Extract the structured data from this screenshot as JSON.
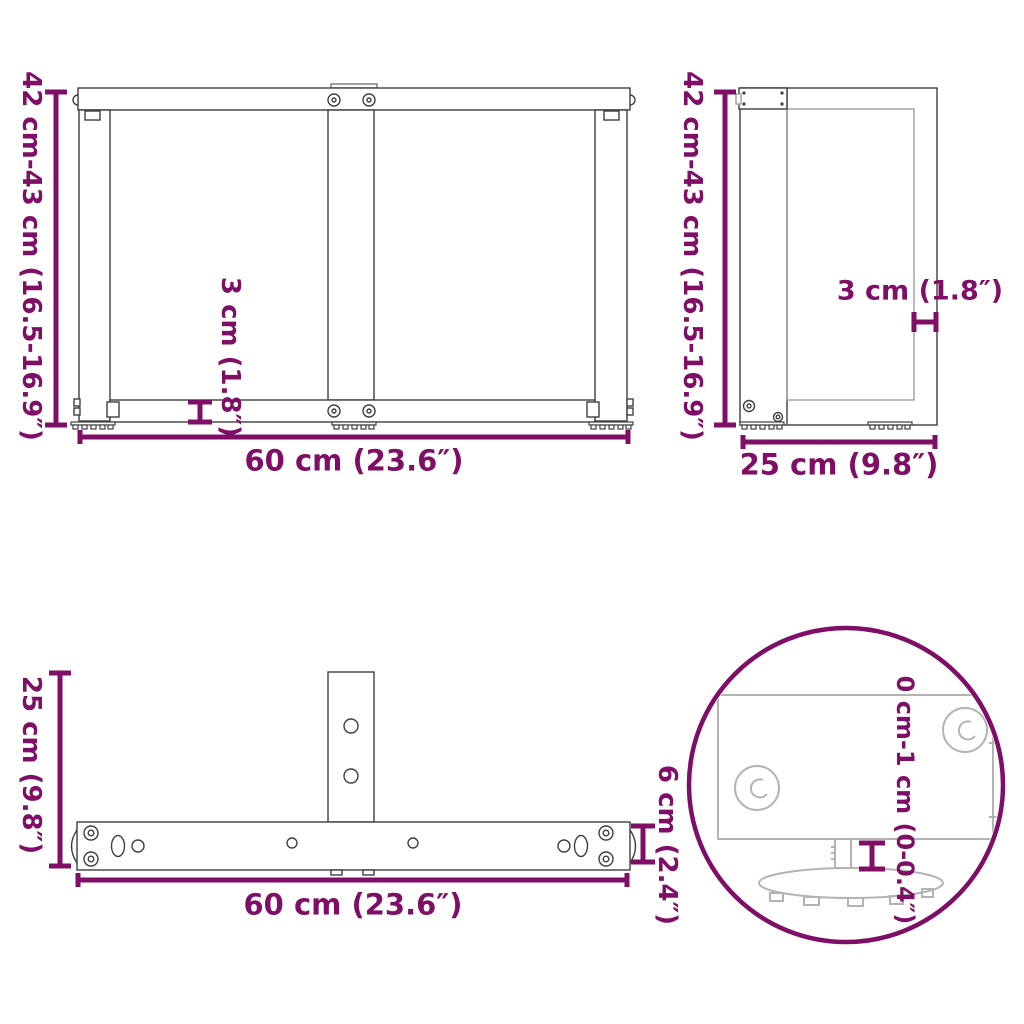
{
  "document": {
    "type": "product-dimension-diagram",
    "subject": "T-shaped table leg frame",
    "background_color": "#FFFFFF",
    "accent_color": "#7F0E66",
    "drawing_color_dark": "#3F3F3F",
    "drawing_color_light": "#9E9E9E",
    "detail_drawing_color": "#B3B3B3"
  },
  "views": {
    "front": {
      "name": "front-view",
      "height": "42 cm-43 cm (16.5-16.9″)",
      "width": "60 cm (23.6″)",
      "plate_thickness": "3 cm (1.8″)"
    },
    "side": {
      "name": "side-view",
      "height": "42 cm-43 cm (16.5-16.9″)",
      "depth": "25 cm (9.8″)",
      "profile_thickness": "3 cm (1.8″)"
    },
    "top": {
      "name": "top-view",
      "depth": "25 cm (9.8″)",
      "width": "60 cm (23.6″)",
      "bar_width": "6 cm (2.4″)"
    },
    "detail": {
      "name": "adjustable-foot-detail",
      "foot_adjustment": "0 cm-1 cm (0-0.4″)"
    }
  }
}
